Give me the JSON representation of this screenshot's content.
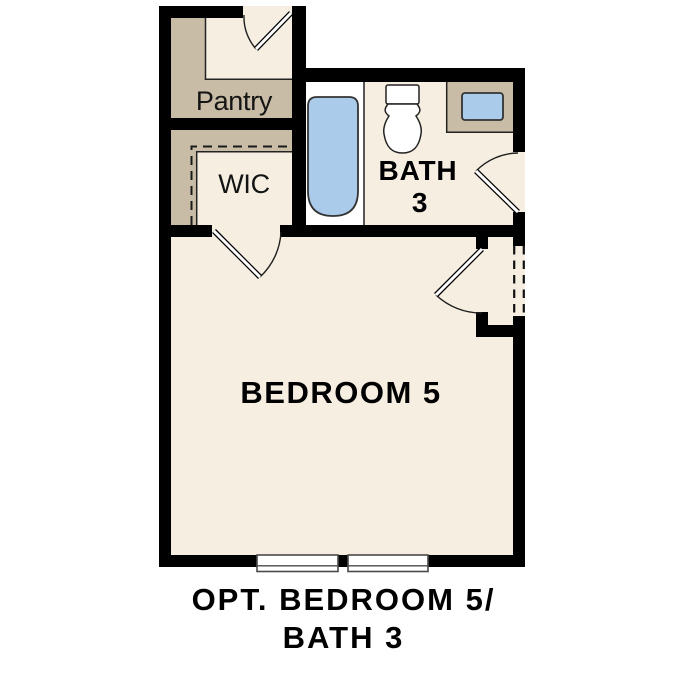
{
  "colors": {
    "background": "#ffffff",
    "floor": "#f6eee1",
    "shelf": "#c9bca6",
    "water": "#abcbea",
    "wall": "#000000",
    "window-frame": "#4a4a4a",
    "text": "#000000"
  },
  "rooms": {
    "pantry": {
      "label": "Pantry"
    },
    "wic": {
      "label": "WIC"
    },
    "bath3": {
      "line1": "BATH",
      "line2": "3"
    },
    "bedroom5": {
      "label": "BEDROOM 5"
    }
  },
  "caption": {
    "line1": "OPT. BEDROOM 5/",
    "line2": "BATH 3"
  }
}
